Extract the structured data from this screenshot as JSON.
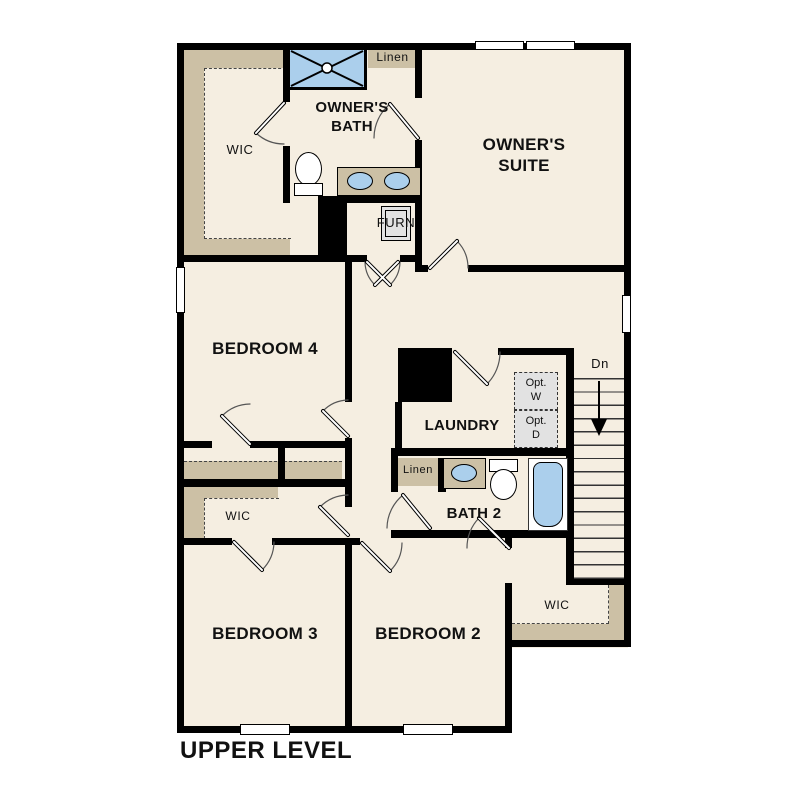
{
  "plan": {
    "title": "UPPER LEVEL",
    "labels": {
      "owners_suite": "OWNER'S SUITE",
      "owners_bath": "OWNER'S BATH",
      "owners_wic": "WIC",
      "linen_upper": "Linen",
      "furnace": "FURN",
      "bedroom4": "BEDROOM 4",
      "laundry": "LAUNDRY",
      "opt_washer": {
        "line1": "Opt.",
        "line2": "W"
      },
      "opt_dryer": {
        "line1": "Opt.",
        "line2": "D"
      },
      "stairs_down": "Dn",
      "linen_bath2": "Linen",
      "bath2": "BATH 2",
      "wic_bedroom3": "WIC",
      "wic_bedroom2": "WIC",
      "bedroom3": "BEDROOM 3",
      "bedroom2": "BEDROOM 2"
    },
    "colors": {
      "floor": "#f5eee1",
      "wall": "#000000",
      "shelving_tan": "#ccc0a5",
      "fixture_blue": "#abcfec",
      "appliance_gray": "#e2e2e2"
    }
  }
}
